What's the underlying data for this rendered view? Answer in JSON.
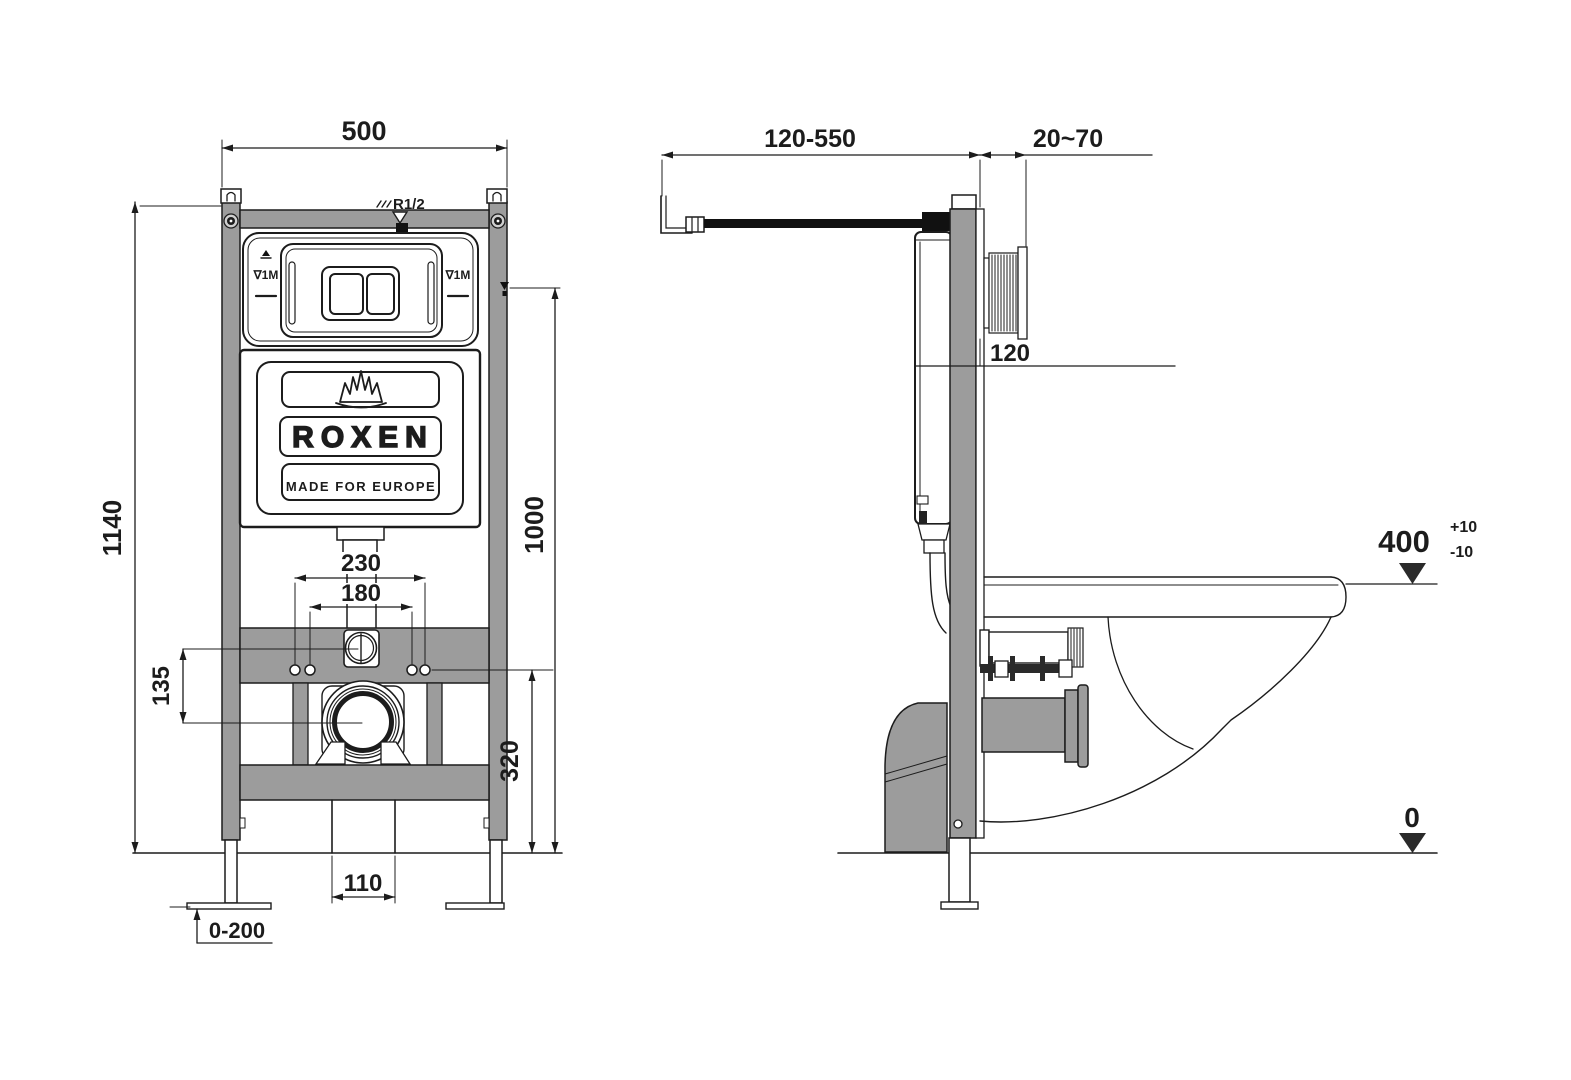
{
  "title": "ROXEN concealed cistern installation frame drawing",
  "colors": {
    "frame_gray": "#9c9c9c",
    "line": "#1c1c1c",
    "pipe_black": "#111111",
    "background": "#ffffff"
  },
  "front_view": {
    "dim_width": "500",
    "dim_height": "1140",
    "dim_plate_center": "1000",
    "dim_drain_flange": "230",
    "dim_studs": "180",
    "dim_inlet_offset": "135",
    "dim_stud_height": "320",
    "dim_outlet": "110",
    "dim_leg_adjust": "0-200",
    "label_supply": "R1/2",
    "label_level_left": "∇1M",
    "label_level_right": "∇1M",
    "brand": "ROXEN",
    "tagline": "MADE FOR EUROPE"
  },
  "side_view": {
    "dim_supply_range": "120-550",
    "dim_plate_depth": "20~70",
    "dim_frame_depth": "120",
    "dim_rim_height": "400",
    "dim_rim_tol_plus": "+10",
    "dim_rim_tol_minus": "-10",
    "dim_floor": "0"
  }
}
